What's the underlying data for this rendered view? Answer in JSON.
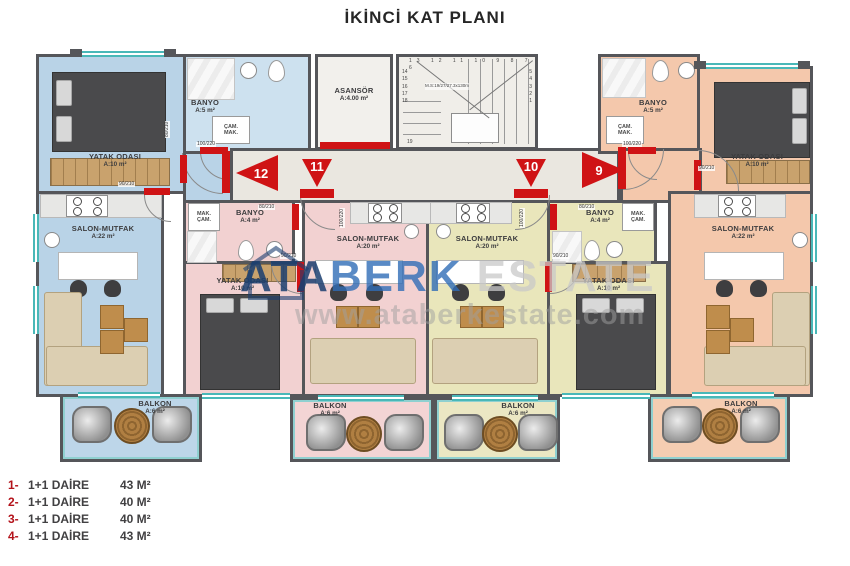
{
  "title": "İKİNCİ KAT PLANI",
  "watermark": {
    "part1": "ATA",
    "part2": "BERK",
    "part3": "ESTATE",
    "url": "www.ataberkestate.com"
  },
  "core": {
    "elevator_name": "ASANSÖR",
    "elevator_area": "A:4.00 m²",
    "stairs_note": "M.S:19/27/27.3x130m",
    "stairs_top": "13 12 11 10 9 8 7 6",
    "stairs_right": "5\n4\n3\n2\n1",
    "stairs_left": "14\n15\n16\n17\n18",
    "stairs_bottom": "19"
  },
  "doors": {
    "d12": "12",
    "d11": "11",
    "d10": "10",
    "d9": "9"
  },
  "door_sizes": [
    "100/220",
    "90/210",
    "80/210",
    "100/220",
    "80/210",
    "90/210",
    "100/220",
    "80/210",
    "90/210",
    "100/220",
    "90/210"
  ],
  "units": {
    "u1": {
      "bedroom_name": "YATAK ODASI",
      "bedroom_area": "A:10 m²",
      "bath_name": "BANYO",
      "bath_area": "A:5 m²",
      "wm": "ÇAM.\nMAK.",
      "salon_name": "SALON-MUTFAK",
      "salon_area": "A:22 m²",
      "balcony_name": "BALKON",
      "balcony_area": "A:6 m²"
    },
    "u2": {
      "bath_name": "BANYO",
      "bath_area": "A:4 m²",
      "wm": "MAK.\nÇAM.",
      "bedroom_name": "YATAK ODASI",
      "bedroom_area": "A:10 m²",
      "salon_name": "SALON-MUTFAK",
      "salon_area": "A:20 m²",
      "balcony_name": "BALKON",
      "balcony_area": "A:6 m²"
    },
    "u3": {
      "bath_name": "BANYO",
      "bath_area": "A:4 m²",
      "wm": "MAK.\nÇAM.",
      "bedroom_name": "YATAK ODASI",
      "bedroom_area": "A:10 m²",
      "salon_name": "SALON-MUTFAK",
      "salon_area": "A:20 m²",
      "balcony_name": "BALKON",
      "balcony_area": "A:6 m²"
    },
    "u4": {
      "bath_name": "BANYO",
      "bath_area": "A:5 m²",
      "wm": "ÇAM.\nMAK.",
      "bedroom_name": "YATAK ODASI",
      "bedroom_area": "A:10 m²",
      "salon_name": "SALON-MUTFAK",
      "salon_area": "A:22 m²",
      "balcony_name": "BALKON",
      "balcony_area": "A:6 m²"
    }
  },
  "legend": {
    "rows": [
      {
        "num": "1-",
        "label": "1+1 DAİRE",
        "area": "43 M²"
      },
      {
        "num": "2-",
        "label": "1+1 DAİRE",
        "area": "40 M²"
      },
      {
        "num": "3-",
        "label": "1+1 DAİRE",
        "area": "40 M²"
      },
      {
        "num": "4-",
        "label": "1+1 DAİRE",
        "area": "43 M²"
      }
    ]
  }
}
